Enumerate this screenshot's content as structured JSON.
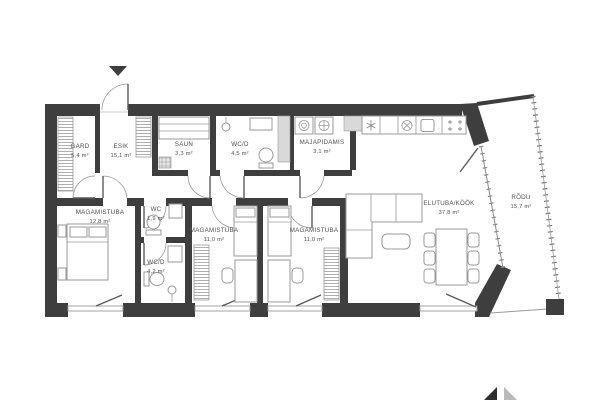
{
  "plan": {
    "rooms": [
      {
        "id": "gard",
        "name": "GARD",
        "area": "5,4 m²"
      },
      {
        "id": "esik",
        "name": "ESIK",
        "area": "15,1 m²"
      },
      {
        "id": "saun",
        "name": "SAUN",
        "area": "3,3 m²"
      },
      {
        "id": "wcd-top",
        "name": "WC/D",
        "area": "4,5 m²"
      },
      {
        "id": "majapidamis",
        "name": "MAJAPIDAMIS",
        "area": "3,1 m²"
      },
      {
        "id": "magamistuba-master",
        "name": "MAGAMISTUBA",
        "area": "12,8 m²"
      },
      {
        "id": "wc",
        "name": "WC",
        "area": "1,9 m²"
      },
      {
        "id": "wcd-ensuite",
        "name": "WC/D",
        "area": "4,2 m²"
      },
      {
        "id": "magamistuba-1",
        "name": "MAGAMISTUBA",
        "area": "11,0 m²"
      },
      {
        "id": "magamistuba-2",
        "name": "MAGAMISTUBA",
        "area": "11,0 m²"
      },
      {
        "id": "elutuba-kook",
        "name": "ELUTUBA/KÖÖK",
        "area": "37,8 m²"
      },
      {
        "id": "rodu",
        "name": "RÕDU",
        "area": "15,7 m²"
      }
    ],
    "colors": {
      "wall": "#3e3e3e",
      "furniture_outline": "#9a9a9a",
      "niche": "#d9d9d9",
      "label": "#4f4f4f",
      "background": "#ffffff"
    }
  }
}
